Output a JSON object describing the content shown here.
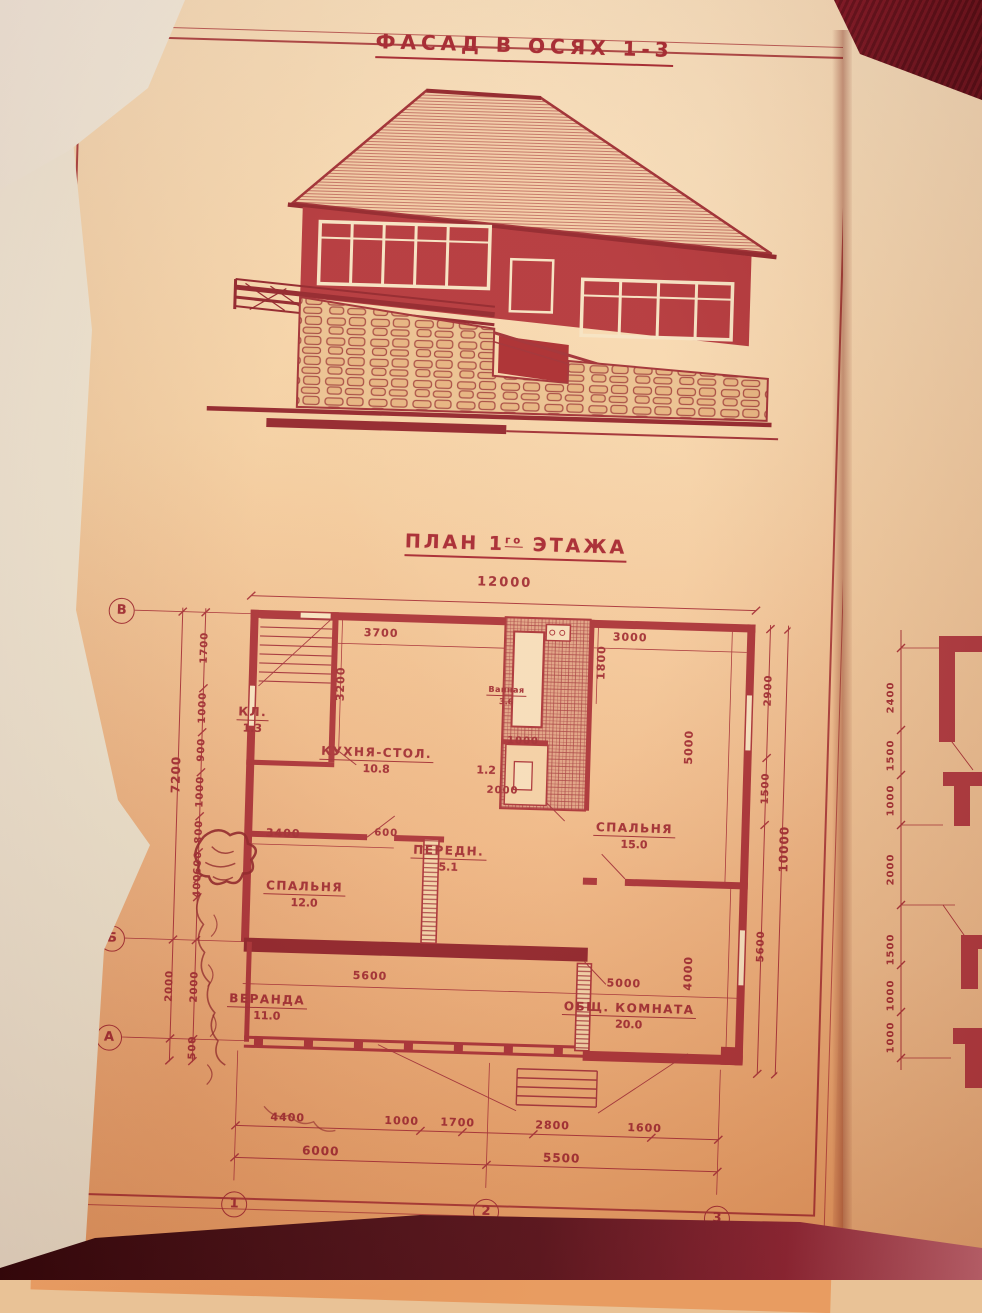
{
  "titles": {
    "facade": "ФАСАД В ОСЯХ 1-3",
    "plan_prefix": "ПЛАН 1",
    "plan_sup": "го",
    "plan_suffix": "ЭТАЖА"
  },
  "plan": {
    "overall_width": "12000",
    "rooms": [
      {
        "name": "Ванная",
        "area": "3.6"
      },
      {
        "name": "КЛ.",
        "area": "1.3"
      },
      {
        "name": "КУХНЯ-СТОЛ.",
        "area": "10.8"
      },
      {
        "name": "СПАЛЬНЯ",
        "area": "15.0"
      },
      {
        "name": "ПЕРЕДН.",
        "area": "5.1"
      },
      {
        "name": "СПАЛЬНЯ",
        "area": "12.0"
      },
      {
        "name": "ВЕРАНДА",
        "area": "11.0"
      },
      {
        "name": "ОБЩ. КОМНАТА",
        "area": "20.0"
      },
      {
        "area": "1.2"
      }
    ],
    "interior_dims": [
      "3200",
      "3700",
      "3000",
      "1800",
      "1000",
      "2000",
      "3400",
      "600",
      "5000",
      "5600",
      "5000",
      "4000"
    ],
    "left_chain": [
      "1700",
      "1000",
      "900",
      "1000",
      "800",
      "600",
      "400"
    ],
    "left_overall": "7200",
    "left_lower": [
      "2000",
      "2000",
      "500"
    ],
    "right_chain": [
      "2900",
      "1500",
      "5600"
    ],
    "right_overall": "10000",
    "bottom_chain": [
      "4400",
      "1000",
      "1700",
      "2800",
      "1600"
    ],
    "bottom_overall": [
      "6000",
      "5500"
    ],
    "axis_rows": [
      "В",
      "Б",
      "А"
    ],
    "axis_cols": [
      "1",
      "2",
      "3"
    ]
  },
  "side_panel": {
    "dims": [
      "2400",
      "1500",
      "1000",
      "2000",
      "1500",
      "1000",
      "1000"
    ]
  },
  "colors": {
    "ink": "#a12b31",
    "paper": "#f2c89c",
    "fabric": "#6d0d1a"
  }
}
